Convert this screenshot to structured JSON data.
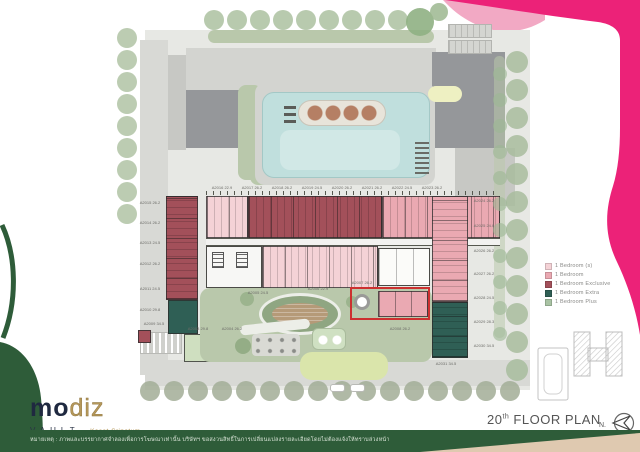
{
  "branding": {
    "logo_part1": "mo",
    "logo_part2": "diz",
    "brand_line": "VAULT",
    "brand_location": "Kaset-Sripatum"
  },
  "title": {
    "floor_num": "20",
    "floor_sup": "th",
    "floor_text": " FLOOR PLAN",
    "north": "N."
  },
  "legend": {
    "items": [
      {
        "label": "1 Bedroom (s)",
        "color": "#f4d2d6"
      },
      {
        "label": "1 Bedroom",
        "color": "#eaa9b2"
      },
      {
        "label": "1 Bedroom Exclusive",
        "color": "#a3505a"
      },
      {
        "label": "1 Bedroom Extra",
        "color": "#2f5f55"
      },
      {
        "label": "1 Bedroom Plus",
        "color": "#a9c3a4"
      }
    ]
  },
  "disclaimer": "หมายเหตุ : ภาพและบรรยากาศจำลองเพื่อการโฆษณาเท่านั้น บริษัทฯ ขอสงวนสิทธิ์ในการเปลี่ยนแปลงรายละเอียดโดยไม่ต้องแจ้งให้ทราบล่วงหน้า",
  "plan": {
    "colors": {
      "site": "#e7e8e4",
      "road": "#d8d9d5",
      "deck": "#d3d4d0",
      "roofD": "#95979a",
      "roofL": "#c7c8c4",
      "pool": "#c0dfdd",
      "poolEdge": "#a3c8c6",
      "sage": "#b9c8ab",
      "lawn": "#dae5ab",
      "unitS": "#f4d2d6",
      "unit1": "#eaa9b2",
      "unitEx": "#a3505a",
      "unitXtra": "#2f5f55",
      "unitPlus": "#cfdfc0",
      "hl": "#cc3030",
      "magenta": "#ec2278",
      "pinklight": "#f2a9c4",
      "green": "#2e5c39",
      "beige": "#dfc9b0",
      "gold": "#b5985a",
      "navy": "#1f2940"
    },
    "unit_labels": [
      {
        "x": 150,
        "y": 201,
        "t": "A2015 26.2"
      },
      {
        "x": 150,
        "y": 221,
        "t": "A2014 26.2"
      },
      {
        "x": 150,
        "y": 241,
        "t": "A2013 24.5"
      },
      {
        "x": 150,
        "y": 262,
        "t": "A2012 26.2"
      },
      {
        "x": 150,
        "y": 287,
        "t": "A2011 24.5"
      },
      {
        "x": 150,
        "y": 308,
        "t": "A2010 29.8"
      },
      {
        "x": 154,
        "y": 322,
        "t": "A2009 34.5"
      },
      {
        "x": 484,
        "y": 199,
        "t": "A2024 26.2"
      },
      {
        "x": 484,
        "y": 224,
        "t": "A2025 24.0"
      },
      {
        "x": 484,
        "y": 249,
        "t": "A2026 26.2"
      },
      {
        "x": 484,
        "y": 272,
        "t": "A2027 26.2"
      },
      {
        "x": 484,
        "y": 296,
        "t": "A2028 24.5"
      },
      {
        "x": 484,
        "y": 320,
        "t": "A2029 28.3"
      },
      {
        "x": 484,
        "y": 344,
        "t": "A2030 34.5"
      },
      {
        "x": 222,
        "y": 186,
        "t": "A2016 22.9"
      },
      {
        "x": 252,
        "y": 186,
        "t": "A2017 26.2"
      },
      {
        "x": 282,
        "y": 186,
        "t": "A2018 26.2"
      },
      {
        "x": 312,
        "y": 186,
        "t": "A2019 24.5"
      },
      {
        "x": 342,
        "y": 186,
        "t": "A2020 26.2"
      },
      {
        "x": 372,
        "y": 186,
        "t": "A2021 26.2"
      },
      {
        "x": 402,
        "y": 186,
        "t": "A2022 24.5"
      },
      {
        "x": 432,
        "y": 186,
        "t": "A2023 26.2"
      },
      {
        "x": 258,
        "y": 291,
        "t": "A2005 24.5"
      },
      {
        "x": 318,
        "y": 287,
        "t": "A2006 22.9"
      },
      {
        "x": 362,
        "y": 281,
        "t": "A2007 26.2"
      },
      {
        "x": 198,
        "y": 327,
        "t": "A2003 29.8"
      },
      {
        "x": 232,
        "y": 327,
        "t": "A2004 26.2"
      },
      {
        "x": 400,
        "y": 327,
        "t": "A2008 26.2"
      },
      {
        "x": 446,
        "y": 362,
        "t": "A2031 34.5"
      }
    ]
  }
}
